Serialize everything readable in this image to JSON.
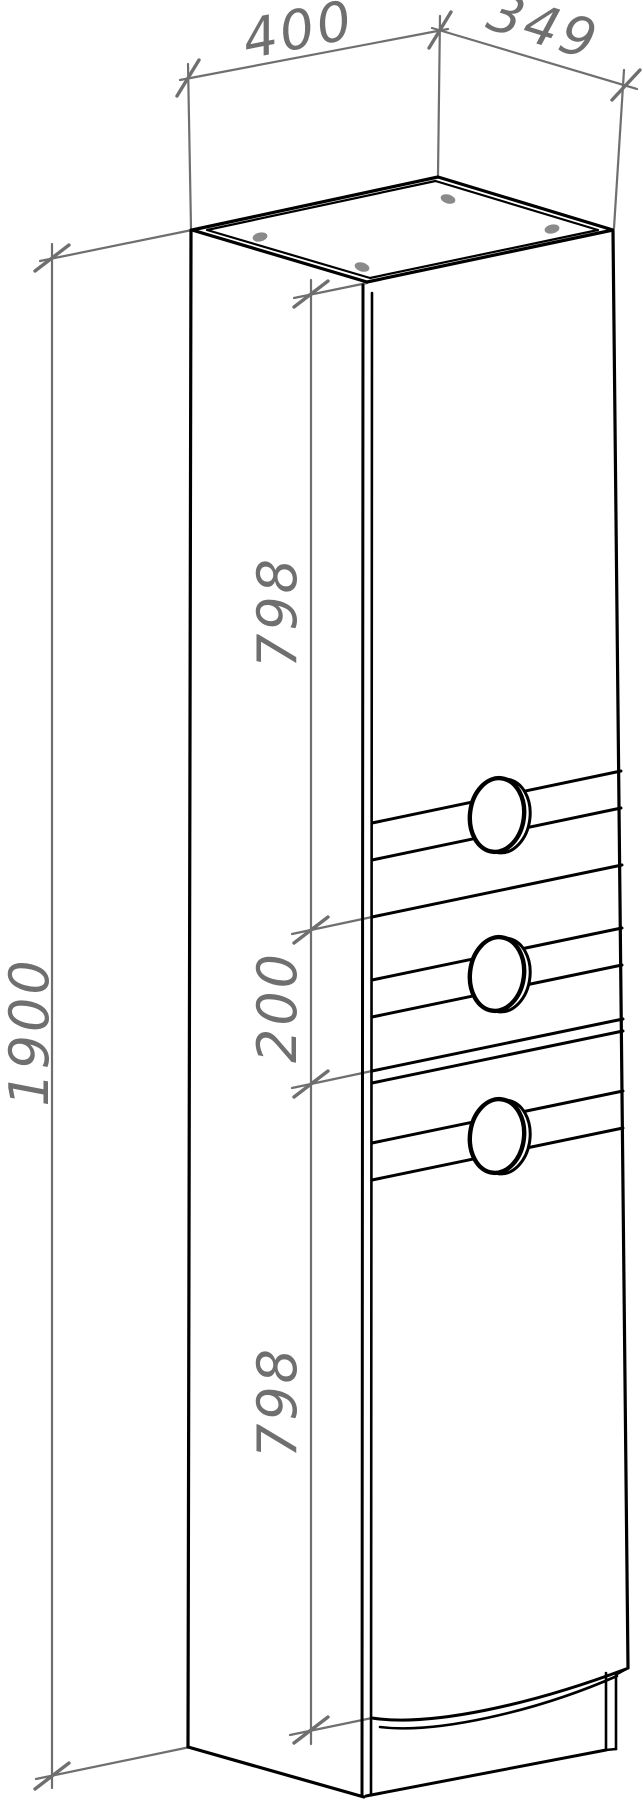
{
  "drawing": {
    "dimensions": {
      "top_width": "400",
      "top_depth": "349",
      "total_height": "1900",
      "upper_section_height": "798",
      "middle_section_height": "200",
      "lower_section_height": "798"
    },
    "colors": {
      "outline": "#000000",
      "dimension": "#6f6f6f",
      "background": "#ffffff",
      "fastener_dot": "#8a8a8a"
    }
  }
}
